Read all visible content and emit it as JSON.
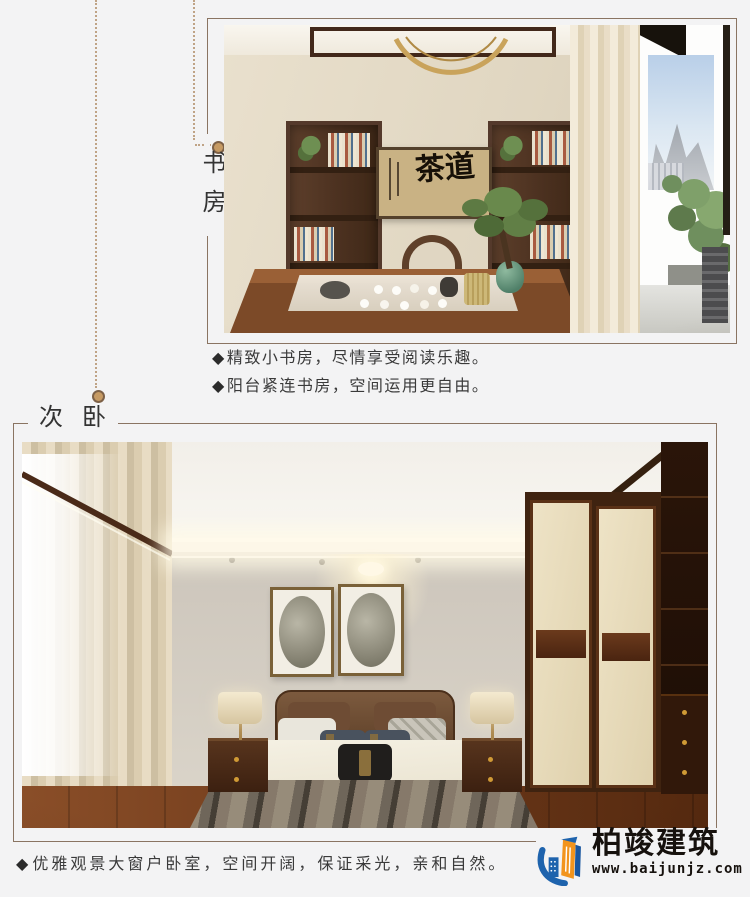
{
  "page": {
    "background_color": "#f3f3f4",
    "frame_line_color": "#8a7462",
    "dotted_line_color": "#bfa386"
  },
  "study_section": {
    "label": "书房",
    "bullets": [
      {
        "marker": "◆",
        "text": "精致小书房，尽情享受阅读乐趣。"
      },
      {
        "marker": "◆",
        "text": "阳台紧连书房，空间运用更自由。"
      }
    ],
    "photo": {
      "artwork_text": "茶道"
    }
  },
  "bedroom_section": {
    "label": "次卧",
    "bullets": [
      {
        "marker": "◆",
        "text": "优雅观景大窗户卧室，空间开阔，保证采光，亲和自然。"
      }
    ]
  },
  "footer": {
    "brand_name": "柏竣建筑",
    "website": "www.baijunjz.com",
    "logo_colors": {
      "blue": "#1e63ad",
      "orange": "#f2941d",
      "text": "#16110d"
    }
  }
}
